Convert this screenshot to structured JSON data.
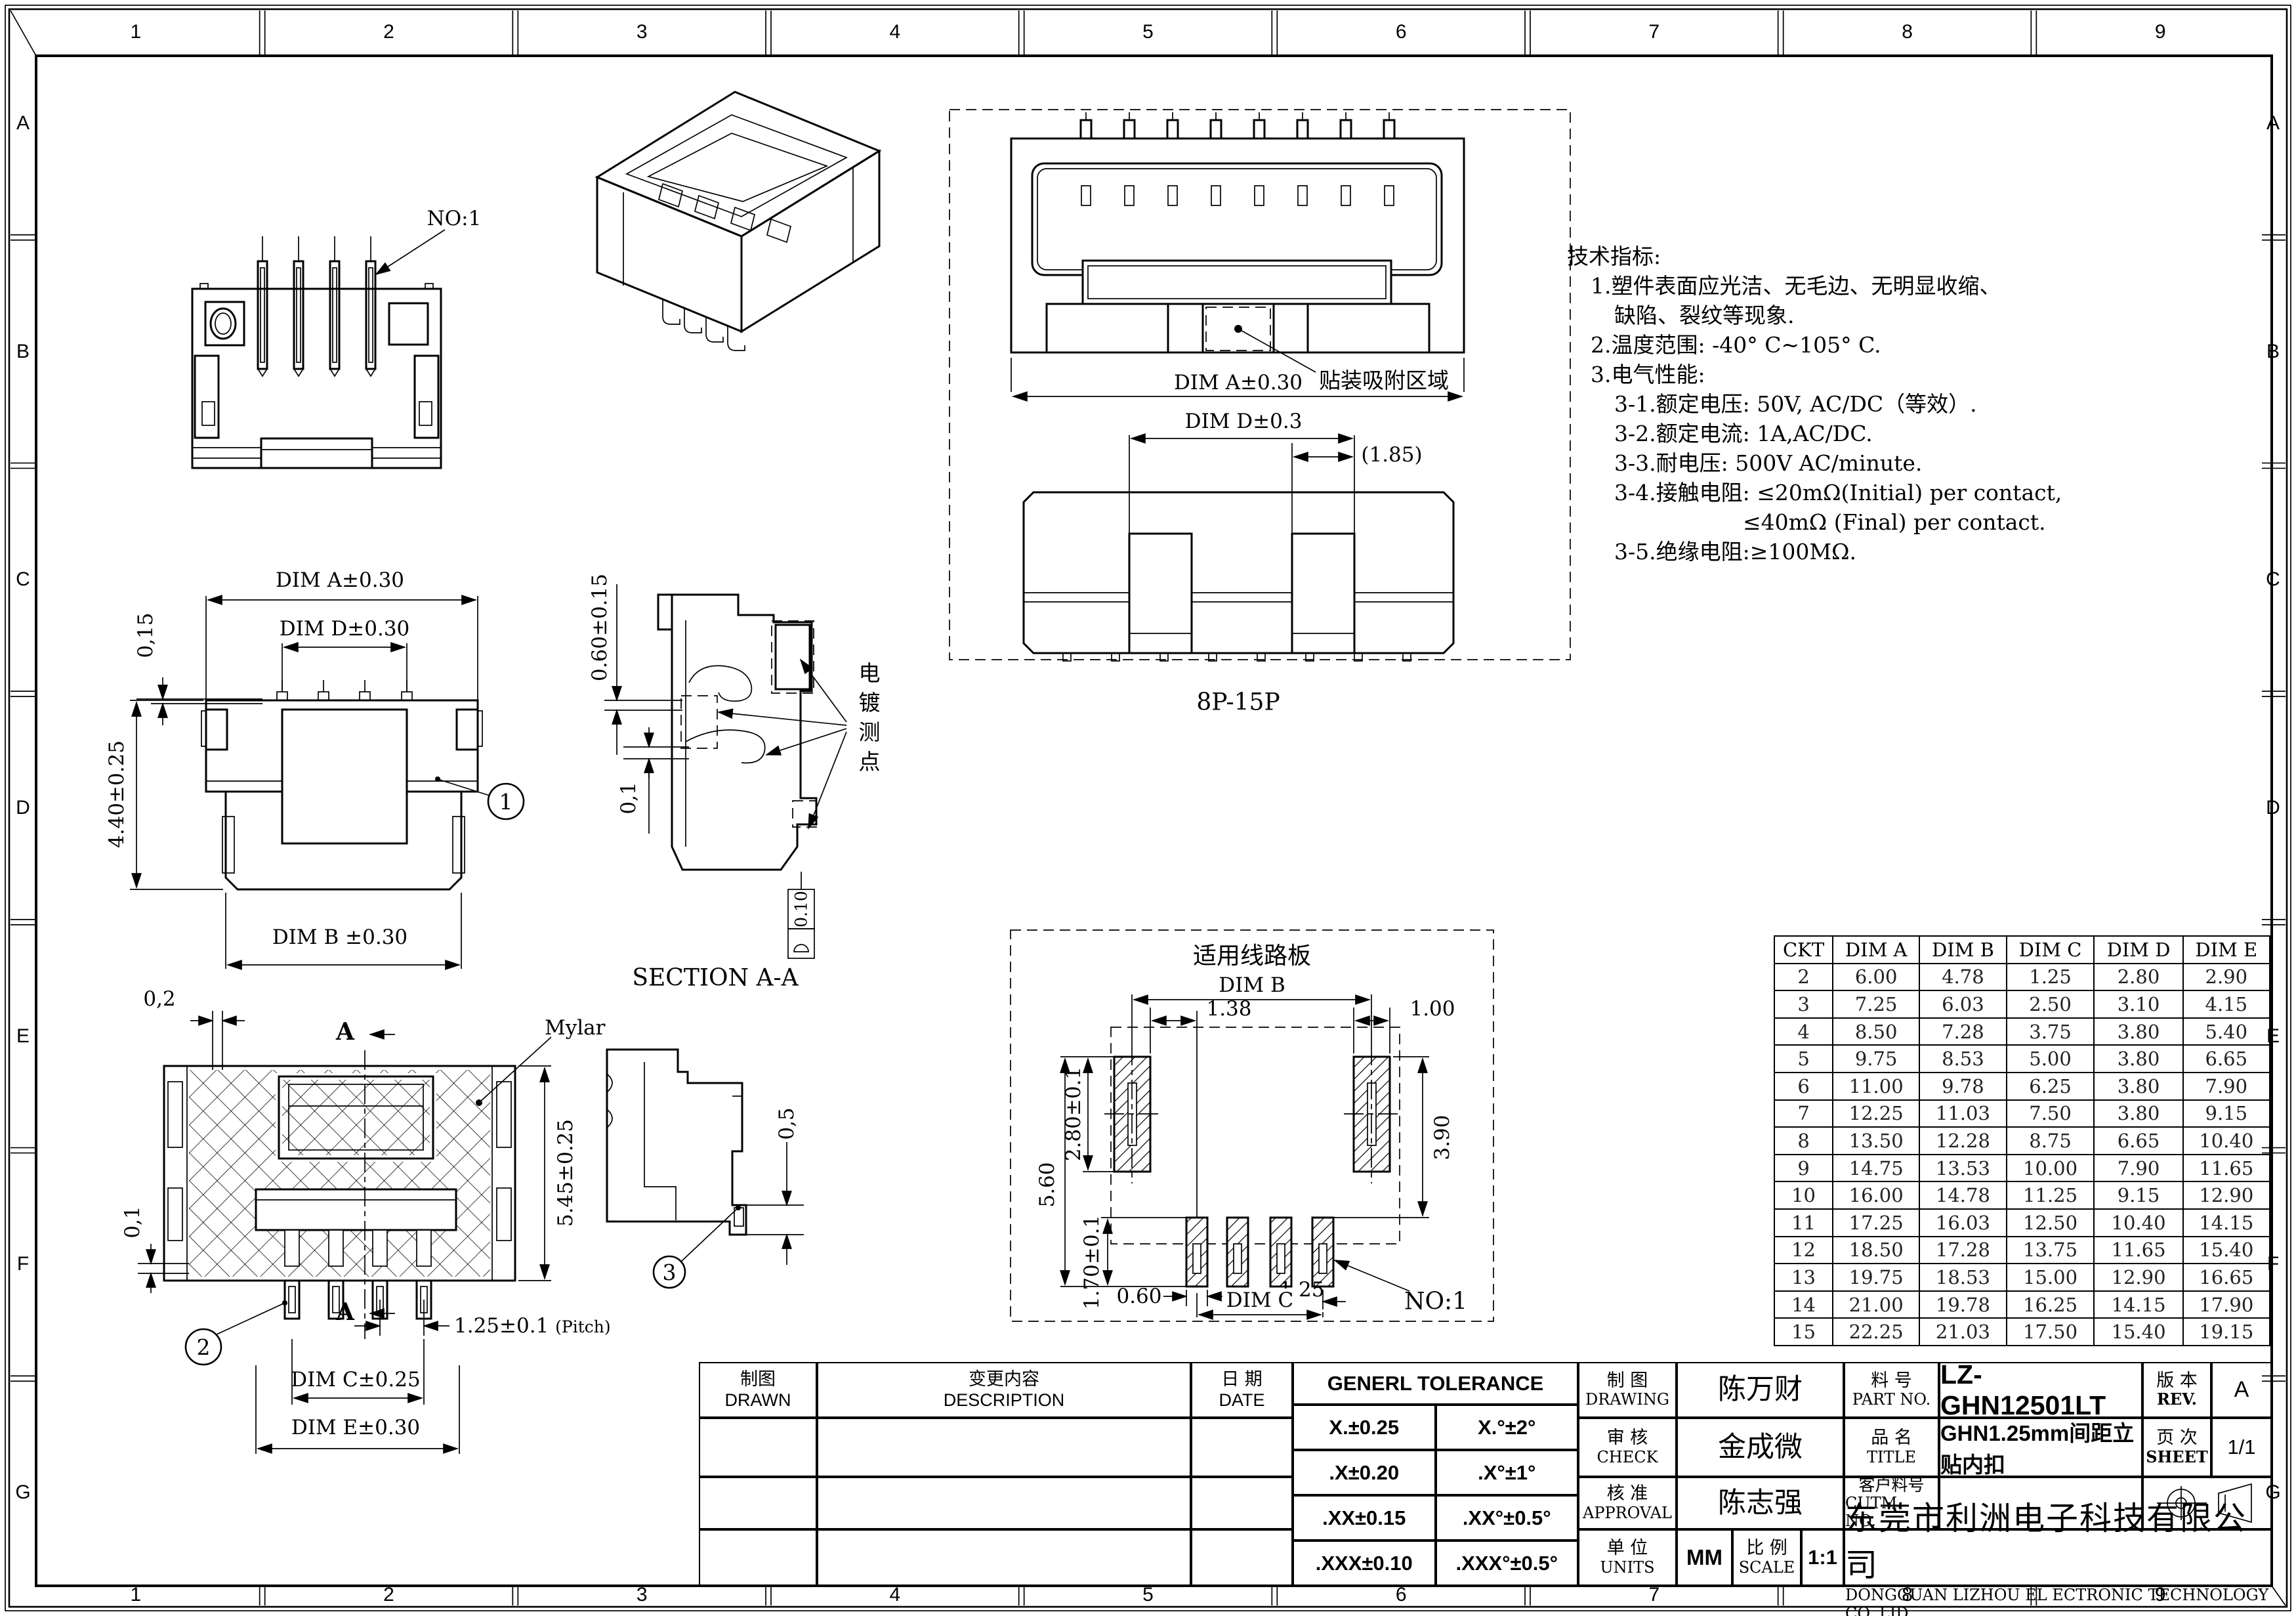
{
  "grid": {
    "columns": [
      "1",
      "2",
      "3",
      "4",
      "5",
      "6",
      "7",
      "8",
      "9"
    ],
    "rows": [
      "A",
      "B",
      "C",
      "D",
      "E",
      "F",
      "G"
    ]
  },
  "views": {
    "front": {
      "no1": "NO:1"
    },
    "dim": {
      "dim_a": "DIM A±0.30",
      "dim_d": "DIM D±0.30",
      "d015": "0,15",
      "d440": "4.40±0.25",
      "dim_b": "DIM B ±0.30",
      "balloon": "1"
    },
    "section": {
      "d060": "0.60±0.15",
      "d01": "0,1",
      "plating": "电镀测点",
      "flatness": "0.10",
      "title": "SECTION A-A"
    },
    "mylar": {
      "d02": "0,2",
      "d01": "0,1",
      "arrow_a_top": "A",
      "arrow_a_bottom": "A",
      "mylar": "Mylar",
      "d545": "5.45±0.25",
      "pitch": "1.25±0.1",
      "pitch_note": "(Pitch)",
      "dim_c": "DIM C±0.25",
      "dim_e": "DIM E±0.30",
      "balloon": "2"
    },
    "side": {
      "d05": "0,5",
      "balloon": "3"
    },
    "smt": {
      "dim_a": "DIM A±0.30",
      "suction": "贴装吸附区域",
      "dim_d": "DIM D±0.3",
      "d185": "(1.85)",
      "title": "8P-15P"
    },
    "pcb": {
      "title": "适用线路板",
      "dim_b": "DIM B",
      "d138": "1.38",
      "d100": "1.00",
      "d280": "2.80±0.1",
      "d560": "5.60",
      "d390": "3.90",
      "d060": "0.60",
      "d125": "1.25",
      "d170": "1.70±0.1",
      "dim_c": "DIM C",
      "no1": "NO:1"
    }
  },
  "tech_notes": {
    "title": "技术指标:",
    "lines": [
      {
        "text": "1.塑件表面应光洁、无毛边、无明显收缩、",
        "indent": 1
      },
      {
        "text": "缺陷、裂纹等现象.",
        "indent": 2
      },
      {
        "text": "2.温度范围: -40° C~105° C.",
        "indent": 1
      },
      {
        "text": "3.电气性能:",
        "indent": 1
      },
      {
        "text": "3-1.额定电压: 50V, AC/DC（等效）.",
        "indent": 2
      },
      {
        "text": "3-2.额定电流: 1A,AC/DC.",
        "indent": 2
      },
      {
        "text": "3-3.耐电压: 500V AC/minute.",
        "indent": 2
      },
      {
        "text": "3-4.接触电阻: ≤20mΩ(Initial) per contact,",
        "indent": 2
      },
      {
        "text": "≤40mΩ (Final) per contact.",
        "indent": 3
      },
      {
        "text": "3-5.绝缘电阻:≥100MΩ.",
        "indent": 2
      }
    ]
  },
  "ckt_table": {
    "headers": [
      "CKT",
      "DIM A",
      "DIM B",
      "DIM C",
      "DIM D",
      "DIM E"
    ],
    "rows": [
      [
        "2",
        "6.00",
        "4.78",
        "1.25",
        "2.80",
        "2.90"
      ],
      [
        "3",
        "7.25",
        "6.03",
        "2.50",
        "3.10",
        "4.15"
      ],
      [
        "4",
        "8.50",
        "7.28",
        "3.75",
        "3.80",
        "5.40"
      ],
      [
        "5",
        "9.75",
        "8.53",
        "5.00",
        "3.80",
        "6.65"
      ],
      [
        "6",
        "11.00",
        "9.78",
        "6.25",
        "3.80",
        "7.90"
      ],
      [
        "7",
        "12.25",
        "11.03",
        "7.50",
        "3.80",
        "9.15"
      ],
      [
        "8",
        "13.50",
        "12.28",
        "8.75",
        "6.65",
        "10.40"
      ],
      [
        "9",
        "14.75",
        "13.53",
        "10.00",
        "7.90",
        "11.65"
      ],
      [
        "10",
        "16.00",
        "14.78",
        "11.25",
        "9.15",
        "12.90"
      ],
      [
        "11",
        "17.25",
        "16.03",
        "12.50",
        "10.40",
        "14.15"
      ],
      [
        "12",
        "18.50",
        "17.28",
        "13.75",
        "11.65",
        "15.40"
      ],
      [
        "13",
        "19.75",
        "18.53",
        "15.00",
        "12.90",
        "16.65"
      ],
      [
        "14",
        "21.00",
        "19.78",
        "16.25",
        "14.15",
        "17.90"
      ],
      [
        "15",
        "22.25",
        "21.03",
        "17.50",
        "15.40",
        "19.15"
      ]
    ]
  },
  "title_block": {
    "drawn": {
      "zh": "制图",
      "en": "DRAWN"
    },
    "description": {
      "zh": "变更内容",
      "en": "DESCRIPTION"
    },
    "date": {
      "zh": "日 期",
      "en": "DATE"
    },
    "tolerance": {
      "title": "GENERL TOLERANCE",
      "rows": [
        [
          "X.±0.25",
          "X.°±2°"
        ],
        [
          ".X±0.20",
          ".X°±1°"
        ],
        [
          ".XX±0.15",
          ".XX°±0.5°"
        ],
        [
          ".XXX±0.10",
          ".XXX°±0.5°"
        ]
      ]
    },
    "signoff": [
      {
        "zh": "制  图",
        "en": "DRAWING",
        "name": "陈万财"
      },
      {
        "zh": "审  核",
        "en": "CHECK",
        "name": "金成微"
      },
      {
        "zh": "核  准",
        "en": "APPROVAL",
        "name": "陈志强"
      }
    ],
    "units": {
      "zh": "单 位",
      "en": "UNITS",
      "value": "MM"
    },
    "scale": {
      "zh": "比 例",
      "en": "SCALE",
      "value": "1:1"
    },
    "part": {
      "zh": "料 号",
      "en": "PART NO.",
      "value": "LZ-GHN12501LT"
    },
    "rev": {
      "zh": "版 本",
      "en": "REV.",
      "value": "A"
    },
    "product": {
      "zh": "品 名",
      "en": "TITLE",
      "value": "GHN1.25mm间距立贴内扣"
    },
    "sheet": {
      "zh": "页 次",
      "en": "SHEET",
      "value": "1/1"
    },
    "customer": {
      "zh": "客户料号",
      "en": "CUTM. NO.",
      "value": ""
    },
    "company_zh": "东莞市利洲电子科技有限公司",
    "company_en": "DONGGUAN LIZHOU EL ECTRONIC TECHNOLOGY CO.,LID"
  }
}
